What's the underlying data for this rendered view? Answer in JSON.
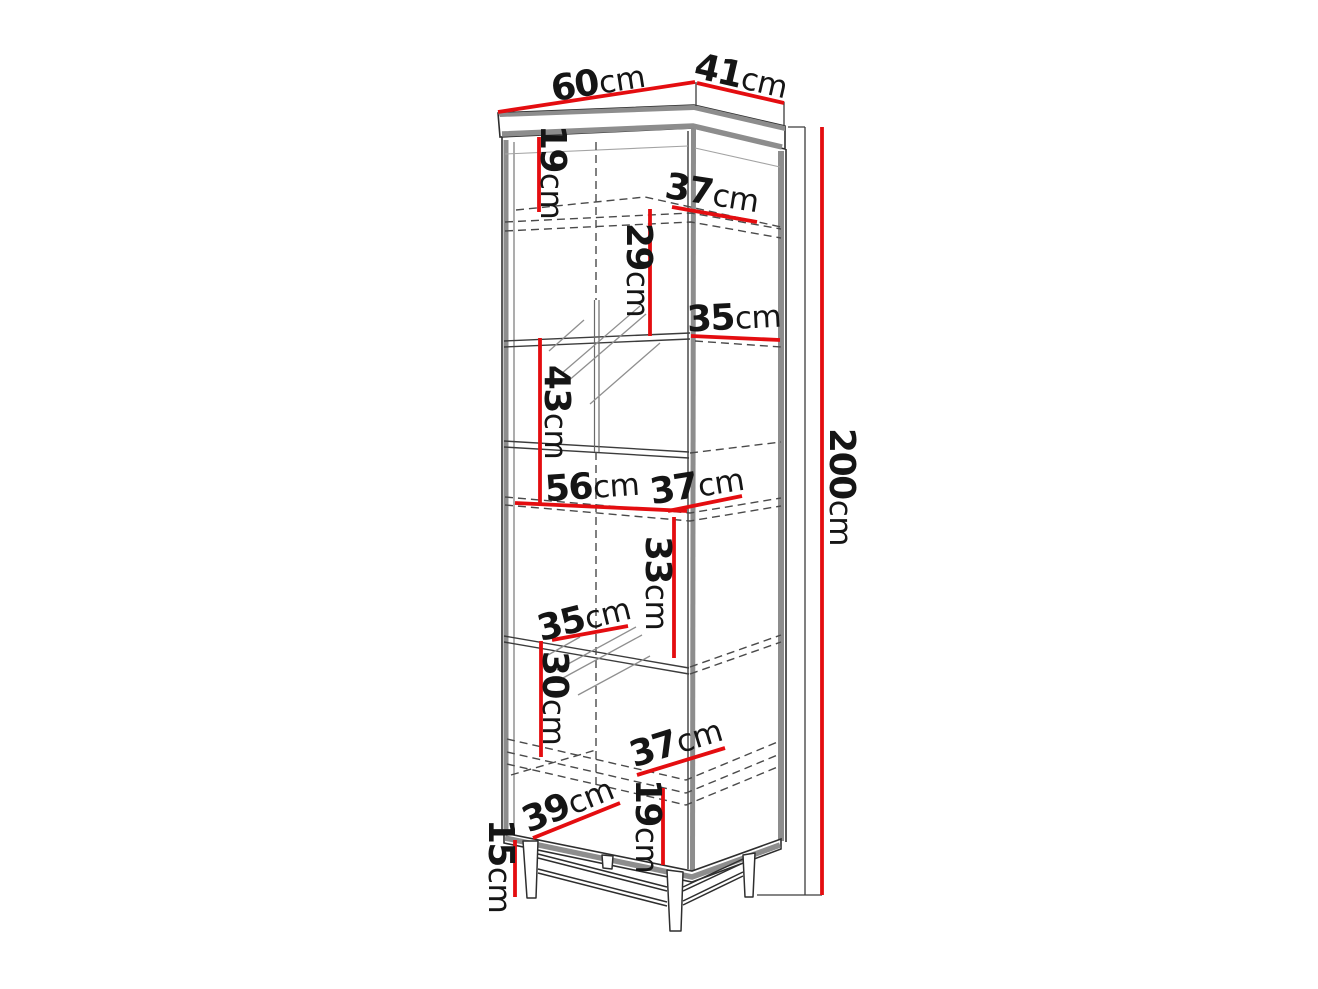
{
  "diagram": {
    "title": "corner-display-cabinet-dimensions",
    "background": "#ffffff",
    "colors": {
      "dimension_line": "#e40d10",
      "panel_gray": "#8d8d8d",
      "outline": "#2e2e2e",
      "hidden_line": "#4a4a4a",
      "text": "#151515"
    },
    "dimensions": {
      "top_width": {
        "value": "60",
        "unit": "cm"
      },
      "top_depth": {
        "value": "41",
        "unit": "cm"
      },
      "top_section_height": {
        "value": "19",
        "unit": "cm"
      },
      "upper_shelf_depth": {
        "value": "37",
        "unit": "cm"
      },
      "upper_section_height": {
        "value": "29",
        "unit": "cm"
      },
      "glass_shelf_depth": {
        "value": "35",
        "unit": "cm"
      },
      "display_section_height": {
        "value": "43",
        "unit": "cm"
      },
      "middle_shelf_width": {
        "value": "56",
        "unit": "cm"
      },
      "middle_shelf_depth": {
        "value": "37",
        "unit": "cm"
      },
      "total_height": {
        "value": "200",
        "unit": "cm"
      },
      "lower_display_height": {
        "value": "33",
        "unit": "cm"
      },
      "lower_glass_shelf_depth": {
        "value": "35",
        "unit": "cm"
      },
      "lower_section_height": {
        "value": "30",
        "unit": "cm"
      },
      "bottom_shelf_depth": {
        "value": "37",
        "unit": "cm"
      },
      "bottom_width": {
        "value": "39",
        "unit": "cm"
      },
      "bottom_section_height": {
        "value": "19",
        "unit": "cm"
      },
      "leg_height": {
        "value": "15",
        "unit": "cm"
      }
    }
  }
}
